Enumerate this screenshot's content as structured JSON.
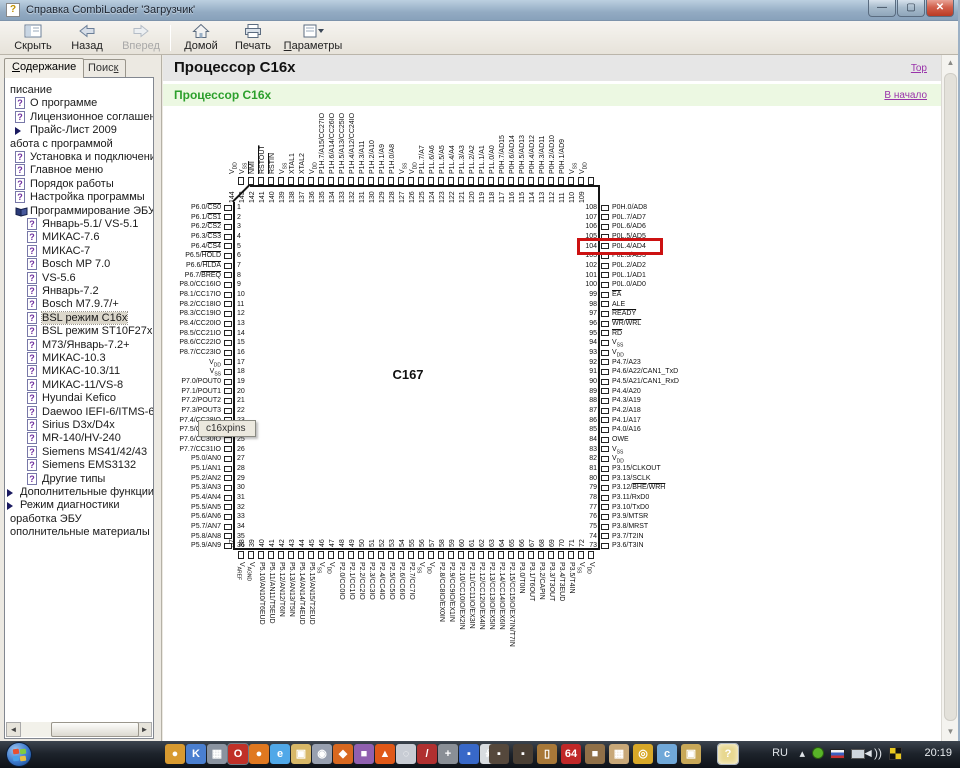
{
  "window": {
    "title": "Справка CombiLoader 'Загрузчик'",
    "controls": [
      "minimize",
      "maximize",
      "close"
    ]
  },
  "toolbar": {
    "buttons": [
      {
        "label": "Скрыть",
        "icon": "hide-panel-icon",
        "enabled": true
      },
      {
        "label": "Назад",
        "icon": "back-arrow-icon",
        "enabled": true
      },
      {
        "label": "Вперед",
        "icon": "forward-arrow-icon",
        "enabled": false
      },
      {
        "label": "Домой",
        "icon": "home-icon",
        "enabled": true
      },
      {
        "label": "Печать",
        "icon": "print-icon",
        "enabled": true
      },
      {
        "label": "Параметры",
        "icon": "options-icon",
        "enabled": true,
        "accel": 0,
        "dropdown": true
      }
    ]
  },
  "sidebar": {
    "tabs": [
      {
        "label": "Содержание",
        "accel": 0,
        "active": true
      },
      {
        "label": "Поиск",
        "accel": 4,
        "active": false
      }
    ],
    "tree": [
      {
        "t": "писание",
        "icon": "none",
        "lvl": "cut"
      },
      {
        "t": "О программе",
        "icon": "question-page-icon",
        "lvl": "l1"
      },
      {
        "t": "Лицензионное соглашение",
        "icon": "question-page-icon",
        "lvl": "l1"
      },
      {
        "t": "Прайс-Лист 2009",
        "icon": "arrow-icon",
        "lvl": "l1"
      },
      {
        "t": "абота с программой",
        "icon": "none",
        "lvl": "cut"
      },
      {
        "t": "Установка и подключение",
        "icon": "question-page-icon",
        "lvl": "l1"
      },
      {
        "t": "Главное меню",
        "icon": "question-page-icon",
        "lvl": "l1"
      },
      {
        "t": "Порядок работы",
        "icon": "question-page-icon",
        "lvl": "l1"
      },
      {
        "t": "Настройка программы",
        "icon": "question-page-icon",
        "lvl": "l1"
      },
      {
        "t": "Программирование ЭБУ",
        "icon": "book-icon",
        "lvl": "l1"
      },
      {
        "t": "Январь-5.1/ VS-5.1",
        "icon": "question-page-icon",
        "lvl": "l2"
      },
      {
        "t": "МИКАС-7.6",
        "icon": "question-page-icon",
        "lvl": "l2"
      },
      {
        "t": "МИКАС-7",
        "icon": "question-page-icon",
        "lvl": "l2"
      },
      {
        "t": "Bosch MP 7.0",
        "icon": "question-page-icon",
        "lvl": "l2"
      },
      {
        "t": "VS-5.6",
        "icon": "question-page-icon",
        "lvl": "l2"
      },
      {
        "t": "Январь-7.2",
        "icon": "question-page-icon",
        "lvl": "l2"
      },
      {
        "t": "Bosch M7.9.7/+",
        "icon": "question-page-icon",
        "lvl": "l2"
      },
      {
        "t": "BSL режим C16x",
        "icon": "question-page-icon",
        "lvl": "l2",
        "sel": true
      },
      {
        "t": "BSL режим ST10F27x",
        "icon": "question-page-icon",
        "lvl": "l2"
      },
      {
        "t": "М73/Январь-7.2+",
        "icon": "question-page-icon",
        "lvl": "l2"
      },
      {
        "t": "МИКАС-10.3",
        "icon": "question-page-icon",
        "lvl": "l2"
      },
      {
        "t": "МИКАС-10.3/11",
        "icon": "question-page-icon",
        "lvl": "l2"
      },
      {
        "t": "МИКАС-11/VS-8",
        "icon": "question-page-icon",
        "lvl": "l2"
      },
      {
        "t": "Hyundai Kefico",
        "icon": "question-page-icon",
        "lvl": "l2"
      },
      {
        "t": "Daewoo IEFI-6/ITMS-6F",
        "icon": "question-page-icon",
        "lvl": "l2"
      },
      {
        "t": "Sirius D3x/D4x",
        "icon": "question-page-icon",
        "lvl": "l2"
      },
      {
        "t": "MR-140/HV-240",
        "icon": "question-page-icon",
        "lvl": "l2"
      },
      {
        "t": "Siemens MS41/42/43",
        "icon": "question-page-icon",
        "lvl": "l2"
      },
      {
        "t": "Siemens EMS3132",
        "icon": "question-page-icon",
        "lvl": "l2"
      },
      {
        "t": "Другие типы",
        "icon": "question-page-icon",
        "lvl": "l2"
      },
      {
        "t": "Дополнительные функции",
        "icon": "arrow-icon",
        "lvl": "a"
      },
      {
        "t": "Режим диагностики",
        "icon": "arrow-icon",
        "lvl": "a"
      },
      {
        "t": "оработка ЭБУ",
        "icon": "none",
        "lvl": "cut"
      },
      {
        "t": "ополнительные материалы",
        "icon": "none",
        "lvl": "cut"
      }
    ]
  },
  "content": {
    "title": "Процессор C16x",
    "top_link": "Top",
    "section_title": "Процессор C16x",
    "back_link": "В начало"
  },
  "diagram": {
    "chip_label": "C167",
    "tooltip": "c16xpins",
    "highlight_pin": 104,
    "highlight_color": "#cc1111",
    "pins": {
      "top": [
        [
          144,
          "V~DD"
        ],
        [
          143,
          "V~SS"
        ],
        [
          142,
          "^NMI^"
        ],
        [
          141,
          "^RSTOUT^"
        ],
        [
          140,
          "^RSTIN^"
        ],
        [
          139,
          "V~SS"
        ],
        [
          138,
          "XTAL1"
        ],
        [
          137,
          "XTAL2"
        ],
        [
          136,
          "V~DD"
        ],
        [
          135,
          "P1H.7/A15/CC27IO"
        ],
        [
          134,
          "P1H.6/A14/CC26IO"
        ],
        [
          133,
          "P1H.5/A13/CC25IO"
        ],
        [
          132,
          "P1H.4/A12/CC24IO"
        ],
        [
          131,
          "P1H.3/A11"
        ],
        [
          130,
          "P1H.2/A10"
        ],
        [
          129,
          "P1H.1/A9"
        ],
        [
          128,
          "P1H.0/A8"
        ],
        [
          127,
          "V~SS"
        ],
        [
          126,
          "V~DD"
        ],
        [
          125,
          "P1L.7/A7"
        ],
        [
          124,
          "P1L.6/A6"
        ],
        [
          123,
          "P1L.5/A5"
        ],
        [
          122,
          "P1L.4/A4"
        ],
        [
          121,
          "P1L.3/A3"
        ],
        [
          120,
          "P1L.2/A2"
        ],
        [
          119,
          "P1L.1/A1"
        ],
        [
          118,
          "P1L.0/A0"
        ],
        [
          117,
          "P0H.7/AD15"
        ],
        [
          116,
          "P0H.6/AD14"
        ],
        [
          115,
          "P0H.5/AD13"
        ],
        [
          114,
          "P0H.4/AD12"
        ],
        [
          113,
          "P0H.3/AD11"
        ],
        [
          112,
          "P0H.2/AD10"
        ],
        [
          111,
          "P0H.1/AD9"
        ],
        [
          110,
          "V~SS"
        ],
        [
          109,
          "V~DD"
        ]
      ],
      "left": [
        [
          1,
          "P6.0/^CS0^"
        ],
        [
          2,
          "P6.1/^CS1^"
        ],
        [
          3,
          "P6.2/^CS2^"
        ],
        [
          4,
          "P6.3/^CS3^"
        ],
        [
          5,
          "P6.4/^CS4^"
        ],
        [
          6,
          "P6.5/^HOLD^"
        ],
        [
          7,
          "P6.6/^HLDA^"
        ],
        [
          8,
          "P6.7/^BREQ^"
        ],
        [
          9,
          "P8.0/CC16IO"
        ],
        [
          10,
          "P8.1/CC17IO"
        ],
        [
          11,
          "P8.2/CC18IO"
        ],
        [
          12,
          "P8.3/CC19IO"
        ],
        [
          13,
          "P8.4/CC20IO"
        ],
        [
          14,
          "P8.5/CC21IO"
        ],
        [
          15,
          "P8.6/CC22IO"
        ],
        [
          16,
          "P8.7/CC23IO"
        ],
        [
          17,
          "V~DD"
        ],
        [
          18,
          "V~SS"
        ],
        [
          19,
          "P7.0/POUT0"
        ],
        [
          20,
          "P7.1/POUT1"
        ],
        [
          21,
          "P7.2/POUT2"
        ],
        [
          22,
          "P7.3/POUT3"
        ],
        [
          23,
          "P7.4/CC28IO"
        ],
        [
          24,
          "P7.5/CC29IO"
        ],
        [
          25,
          "P7.6/CC30IO"
        ],
        [
          26,
          "P7.7/CC31IO"
        ],
        [
          27,
          "P5.0/AN0"
        ],
        [
          28,
          "P5.1/AN1"
        ],
        [
          29,
          "P5.2/AN2"
        ],
        [
          30,
          "P5.3/AN3"
        ],
        [
          31,
          "P5.4/AN4"
        ],
        [
          32,
          "P5.5/AN5"
        ],
        [
          33,
          "P5.6/AN6"
        ],
        [
          34,
          "P5.7/AN7"
        ],
        [
          35,
          "P5.8/AN8"
        ],
        [
          36,
          "P5.9/AN9"
        ]
      ],
      "right": [
        [
          108,
          "P0H.0/AD8"
        ],
        [
          107,
          "P0L.7/AD7"
        ],
        [
          106,
          "P0L.6/AD6"
        ],
        [
          105,
          "P0L.5/AD5"
        ],
        [
          104,
          "P0L.4/AD4"
        ],
        [
          103,
          "P0L.3/AD3"
        ],
        [
          102,
          "P0L.2/AD2"
        ],
        [
          101,
          "P0L.1/AD1"
        ],
        [
          100,
          "P0L.0/AD0"
        ],
        [
          99,
          "^EA^"
        ],
        [
          98,
          "ALE"
        ],
        [
          97,
          "^READY^"
        ],
        [
          96,
          "^WR^/^WRL^"
        ],
        [
          95,
          "^RD^"
        ],
        [
          94,
          "V~SS"
        ],
        [
          93,
          "V~DD"
        ],
        [
          92,
          "P4.7/A23"
        ],
        [
          91,
          "P4.6/A22/CAN1_TxD"
        ],
        [
          90,
          "P4.5/A21/CAN1_RxD"
        ],
        [
          89,
          "P4.4/A20"
        ],
        [
          88,
          "P4.3/A19"
        ],
        [
          87,
          "P4.2/A18"
        ],
        [
          86,
          "P4.1/A17"
        ],
        [
          85,
          "P4.0/A16"
        ],
        [
          84,
          "OWE"
        ],
        [
          83,
          "V~SS"
        ],
        [
          82,
          "V~DD"
        ],
        [
          81,
          "P3.15/CLKOUT"
        ],
        [
          80,
          "P3.13/SCLK"
        ],
        [
          79,
          "P3.12/^BHE^/^WRH^"
        ],
        [
          78,
          "P3.11/RxD0"
        ],
        [
          77,
          "P3.10/TxD0"
        ],
        [
          76,
          "P3.9/MTSR"
        ],
        [
          75,
          "P3.8/MRST"
        ],
        [
          74,
          "P3.7/T2IN"
        ],
        [
          73,
          "P3.6/T3IN"
        ]
      ],
      "bottom": [
        [
          37,
          "V~AREF"
        ],
        [
          38,
          "V~AGND"
        ],
        [
          39,
          "P5.10/AN10/T6EUD"
        ],
        [
          40,
          "P5.11/AN11/T5EUD"
        ],
        [
          41,
          "P5.12/AN12/T6IN"
        ],
        [
          42,
          "P5.13/AN13/T5IN"
        ],
        [
          43,
          "P5.14/AN14/T4EUD"
        ],
        [
          44,
          "P5.15/AN15/T2EUD"
        ],
        [
          45,
          "V~SS"
        ],
        [
          46,
          "V~DD"
        ],
        [
          47,
          "P2.0/CC0IO"
        ],
        [
          48,
          "P2.1/CC1IO"
        ],
        [
          49,
          "P2.2/CC2IO"
        ],
        [
          50,
          "P2.3/CC3IO"
        ],
        [
          51,
          "P2.4/CC4IO"
        ],
        [
          52,
          "P2.5/CC5IO"
        ],
        [
          53,
          "P2.6/CC6IO"
        ],
        [
          54,
          "P2.7/CC7IO"
        ],
        [
          55,
          "V~SS"
        ],
        [
          56,
          "V~DD"
        ],
        [
          57,
          "P2.8/CC8IO/EX0IN"
        ],
        [
          58,
          "P2.9/CC9IO/EX1IN"
        ],
        [
          59,
          "P2.10/CC10IO/EX2IN"
        ],
        [
          60,
          "P2.11/CC11IO/EX3IN"
        ],
        [
          61,
          "P2.12/CC12IO/EX4IN"
        ],
        [
          62,
          "P2.13/CC13IO/EX5IN"
        ],
        [
          63,
          "P2.14/CC14IO/EX6IN"
        ],
        [
          64,
          "P2.15/CC15IO/EX7IN/T7IN"
        ],
        [
          65,
          "P3.0/T0IN"
        ],
        [
          66,
          "P3.1/T6OUT"
        ],
        [
          67,
          "P3.2/CAPIN"
        ],
        [
          68,
          "P3.3/T3OUT"
        ],
        [
          69,
          "P3.4/T3EUD"
        ],
        [
          70,
          "P3.5/T4IN"
        ],
        [
          71,
          "V~SS"
        ],
        [
          72,
          "V~DD"
        ]
      ]
    }
  },
  "taskbar": {
    "start": "start-button",
    "apps": [
      {
        "name": "app-orange-ball",
        "color": "#d89a30",
        "glyph": "●"
      },
      {
        "name": "app-kmplayer",
        "color": "#4a7fd0",
        "glyph": "K"
      },
      {
        "name": "app-image-viewer",
        "color": "#8a93a0",
        "glyph": "▦"
      },
      {
        "name": "app-opera",
        "color": "#c03028",
        "glyph": "O",
        "boxed": true
      },
      {
        "name": "app-firefox",
        "color": "#e07820",
        "glyph": "●"
      },
      {
        "name": "app-internet-explorer",
        "color": "#50a8e8",
        "glyph": "e"
      },
      {
        "name": "app-folder",
        "color": "#d8b868",
        "glyph": "▣"
      },
      {
        "name": "app-media-classic",
        "color": "#98a0b0",
        "glyph": "◉"
      },
      {
        "name": "app-orange-2",
        "color": "#d86820",
        "glyph": "◆"
      },
      {
        "name": "app-purple",
        "color": "#9060b0",
        "glyph": "■"
      },
      {
        "name": "app-fire",
        "color": "#e05818",
        "glyph": "▲"
      },
      {
        "name": "app-media-player",
        "color": "#c8ccd4",
        "glyph": "◌"
      },
      {
        "name": "app-red-pencil",
        "color": "#b03030",
        "glyph": "/"
      },
      {
        "name": "app-crane",
        "color": "#8a8f96",
        "glyph": "+"
      },
      {
        "name": "app-blue-square",
        "color": "#3868c8",
        "glyph": "▪"
      },
      {
        "name": "app-skull",
        "color": "#d8dce0",
        "glyph": "☠"
      },
      {
        "name": "app-dark-1",
        "color": "#55483c",
        "glyph": "▪"
      },
      {
        "name": "app-dark-2",
        "color": "#4a3f34",
        "glyph": "▪"
      },
      {
        "name": "app-door",
        "color": "#a87838",
        "glyph": "▯"
      },
      {
        "name": "app-64",
        "color": "#c02828",
        "glyph": "64"
      },
      {
        "name": "app-brown",
        "color": "#907048",
        "glyph": "■"
      },
      {
        "name": "app-photo",
        "color": "#c8a878",
        "glyph": "▦"
      },
      {
        "name": "app-search",
        "color": "#d8a828",
        "glyph": "◎"
      },
      {
        "name": "app-swirl",
        "color": "#70a8d8",
        "glyph": "c"
      },
      {
        "name": "app-folder-2",
        "color": "#c8a858",
        "glyph": "▣"
      },
      {
        "name": "app-help-viewer",
        "color": "#e8d890",
        "glyph": "?",
        "active": true
      }
    ],
    "tray": {
      "lang": "RU",
      "expand": "▴",
      "time": "20:19"
    }
  }
}
